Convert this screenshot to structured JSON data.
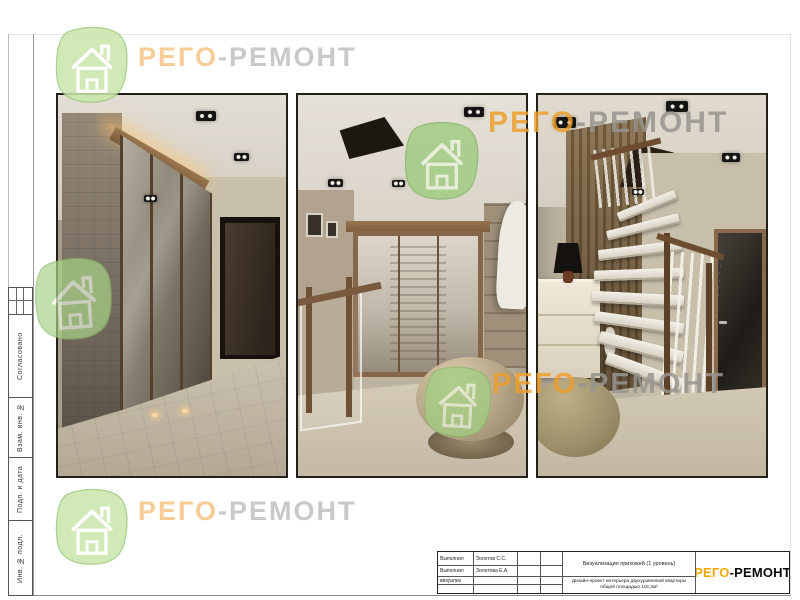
{
  "brand": {
    "name_orange": "РЕГО",
    "name_rest": "-РЕМОНТ",
    "full": "РЕГО-РЕМОНТ",
    "orange_color": "#f0a800",
    "watermark_orange": "#f3aa50",
    "watermark_gray": "#949494",
    "house_green": "#bfe0a0"
  },
  "sidebar": {
    "labels": [
      "Согласовано",
      "Взам. инв. №",
      "Подп. и дата",
      "Инв. № подл."
    ]
  },
  "title_block": {
    "rows": [
      {
        "role": "Выполнил",
        "name": "Золотов С.С."
      },
      {
        "role": "Выполнил",
        "name": "Золотова Е.А."
      },
      {
        "role": "визуализ",
        "name": ""
      }
    ],
    "drawing_title": "Визуализация прихожей (1 уровень)",
    "project_line1": "Дизайн-проект интерьера двухуровневой квартиры",
    "project_line2": "общей площадью 115,3м²",
    "logo_orange": "РЕГО",
    "logo_rest": "-РЕМОНТ"
  }
}
